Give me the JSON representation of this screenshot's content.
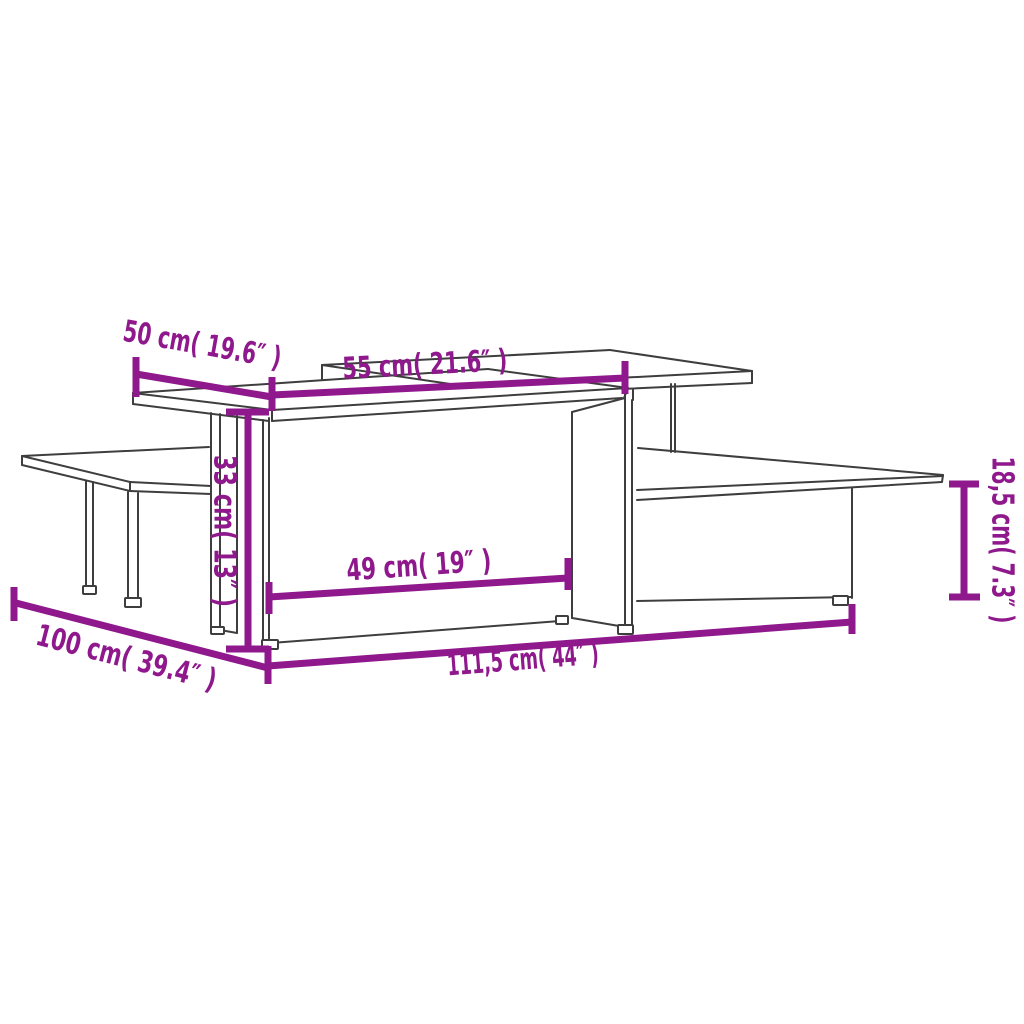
{
  "diagram": {
    "title": "coffee-table-set-dimension-diagram",
    "background_color": "#ffffff",
    "outline_color": "#3e3e3e",
    "accent_color": "#8E188C",
    "outline_stroke_width": 2,
    "dimension_stroke_width": 7,
    "label_font_size": 30,
    "dimensions": [
      {
        "id": "top-depth-left",
        "label": "50 cm( 19.6″ )",
        "value_cm": "50 cm",
        "value_inch": "19.6″",
        "line": [
          136,
          374,
          272,
          397
        ],
        "ticks": [
          [
            136,
            357,
            136,
            397
          ],
          [
            272,
            377,
            272,
            411
          ]
        ],
        "text": {
          "x": 202,
          "y": 346,
          "rotate": 10,
          "length": 160
        }
      },
      {
        "id": "top-depth-right",
        "label": "55 cm( 21.6″ )",
        "value_cm": "55 cm",
        "value_inch": "21.6″",
        "line": [
          272,
          395,
          625,
          378
        ],
        "ticks": [
          [
            625,
            361,
            625,
            394
          ]
        ],
        "text": {
          "x": 425,
          "y": 366,
          "rotate": -3,
          "length": 165
        }
      },
      {
        "id": "height-left",
        "label": "33 cm( 13″ )",
        "value_cm": "33 cm",
        "value_inch": "13″",
        "line": [
          248,
          412,
          248,
          649
        ],
        "ticks": [
          [
            226,
            412,
            269,
            412
          ],
          [
            226,
            649,
            269,
            649
          ]
        ],
        "text": {
          "x": 223,
          "y": 531,
          "rotate": 90,
          "length": 152
        }
      },
      {
        "id": "inner-width",
        "label": "49 cm( 19″ )",
        "value_cm": "49 cm",
        "value_inch": "19″",
        "line": [
          269,
          597,
          568,
          578
        ],
        "ticks": [
          [
            269,
            582,
            269,
            614
          ],
          [
            568,
            558,
            568,
            590
          ]
        ],
        "text": {
          "x": 419,
          "y": 567,
          "rotate": -4,
          "length": 145
        }
      },
      {
        "id": "length-left-table",
        "label": "100 cm( 39.4″ )",
        "value_cm": "100 cm",
        "value_inch": "39.4″",
        "line": [
          16,
          603,
          268,
          668
        ],
        "ticks": [
          [
            14,
            587,
            14,
            621
          ]
        ],
        "text": {
          "x": 126,
          "y": 659,
          "rotate": 14.5,
          "length": 185
        }
      },
      {
        "id": "total-length",
        "label": "111,5 cm( 44″ )",
        "value_cm": "111,5 cm",
        "value_inch": "44″",
        "line": [
          268,
          666,
          852,
          622
        ],
        "ticks": [
          [
            268,
            646,
            268,
            684
          ],
          [
            852,
            604,
            852,
            634
          ]
        ],
        "text": {
          "x": 523,
          "y": 661,
          "rotate": -4.5,
          "length": 152
        }
      },
      {
        "id": "height-right-shelf",
        "label": "18,5 cm( 7.3″ )",
        "value_cm": "18,5 cm",
        "value_inch": "7.3″",
        "line": [
          964,
          484,
          964,
          597
        ],
        "ticks": [
          [
            949,
            484,
            979,
            484
          ],
          [
            949,
            597,
            980,
            597
          ]
        ],
        "text": {
          "x": 1001,
          "y": 540,
          "rotate": 90,
          "length": 167
        }
      }
    ],
    "outline_segments": [
      [
        133,
        393,
        488,
        369
      ],
      [
        488,
        369,
        628,
        388
      ],
      [
        272,
        410,
        628,
        388
      ],
      [
        133,
        393,
        272,
        410
      ],
      [
        133,
        393,
        133,
        404
      ],
      [
        133,
        404,
        269,
        421
      ],
      [
        272,
        410,
        272,
        421
      ],
      [
        272,
        421,
        622,
        398
      ],
      [
        628,
        388,
        624,
        398
      ],
      [
        322,
        365,
        610,
        350
      ],
      [
        610,
        350,
        752,
        371
      ],
      [
        464,
        386,
        752,
        371
      ],
      [
        322,
        365,
        464,
        386
      ],
      [
        752,
        371,
        752,
        383
      ],
      [
        752,
        383,
        622,
        389
      ],
      [
        322,
        365,
        322,
        380
      ],
      [
        671,
        384,
        671,
        452
      ],
      [
        675,
        384,
        675,
        452
      ],
      [
        625,
        389,
        625,
        398
      ],
      [
        633,
        389,
        633,
        400
      ],
      [
        572,
        412,
        572,
        618
      ],
      [
        625,
        398,
        625,
        627
      ],
      [
        632,
        400,
        632,
        630
      ],
      [
        572,
        412,
        625,
        398
      ],
      [
        572,
        618,
        625,
        627
      ],
      [
        625,
        627,
        632,
        630
      ],
      [
        263,
        420,
        263,
        641
      ],
      [
        269,
        418,
        269,
        644
      ],
      [
        263,
        641,
        269,
        644
      ],
      [
        271,
        643,
        560,
        621
      ],
      [
        211,
        413,
        211,
        628
      ],
      [
        220,
        414,
        220,
        630
      ],
      [
        237,
        416,
        237,
        633
      ],
      [
        211,
        628,
        220,
        630
      ],
      [
        220,
        630,
        237,
        633
      ],
      [
        22,
        456,
        209,
        447
      ],
      [
        22,
        456,
        130,
        482
      ],
      [
        130,
        482,
        211,
        486
      ],
      [
        22,
        456,
        22,
        465
      ],
      [
        22,
        465,
        130,
        491
      ],
      [
        130,
        491,
        211,
        494
      ],
      [
        130,
        482,
        130,
        491
      ],
      [
        86,
        481,
        86,
        586
      ],
      [
        93,
        482,
        93,
        587
      ],
      [
        128,
        492,
        128,
        598
      ],
      [
        138,
        493,
        138,
        599
      ],
      [
        638,
        448,
        943,
        475
      ],
      [
        637,
        490,
        943,
        476
      ],
      [
        943,
        475,
        942,
        482
      ],
      [
        637,
        500,
        942,
        482
      ],
      [
        852,
        488,
        852,
        598
      ],
      [
        637,
        601,
        852,
        597
      ]
    ],
    "feet": [
      [
        83,
        586,
        13,
        8
      ],
      [
        125,
        598,
        16,
        9
      ],
      [
        211,
        627,
        13,
        7
      ],
      [
        262,
        640,
        16,
        9
      ],
      [
        556,
        616,
        12,
        8
      ],
      [
        618,
        625,
        15,
        9
      ],
      [
        833,
        596,
        15,
        9
      ]
    ]
  }
}
